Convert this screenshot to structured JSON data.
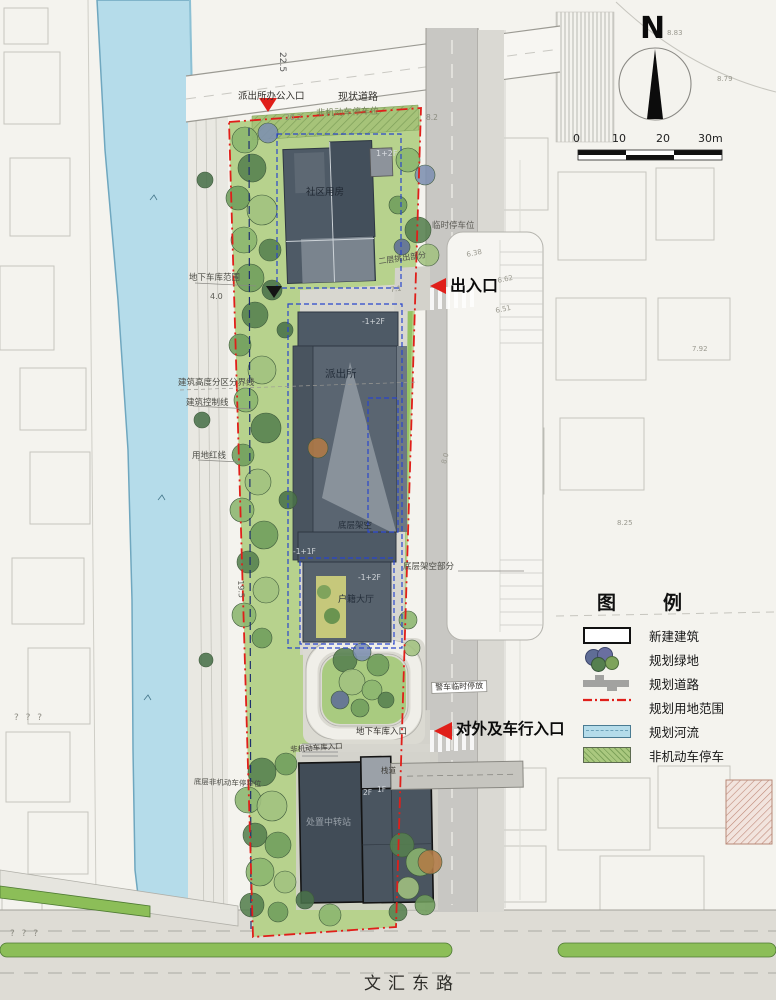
{
  "colors": {
    "boundary_red": "#e01f1a",
    "site_green": "#b7d28d",
    "river_blue": "#b5dcea",
    "road_gray": "#c8c7c3",
    "building_dark": "#4e5a66",
    "bright_green": "#95c463",
    "navy_dash": "#1d2f6e",
    "blue_dash": "#2945cc"
  },
  "compass": {
    "label": "N"
  },
  "scalebar": {
    "t0": "0",
    "t10": "10",
    "t20": "20",
    "t30": "30m"
  },
  "legend": {
    "title": "图　例",
    "items": [
      {
        "key": "new-building",
        "label": "新建建筑"
      },
      {
        "key": "planned-green",
        "label": "规划绿地"
      },
      {
        "key": "planned-road",
        "label": "规划道路"
      },
      {
        "key": "site-boundary",
        "label": "规划用地范围"
      },
      {
        "key": "planned-river",
        "label": "规划河流"
      },
      {
        "key": "nonmotor-parking",
        "label": "非机动车停车"
      }
    ]
  },
  "plan": {
    "dim_22_5": "22.5",
    "office_entrance": "派出所办公入口",
    "existing_road": "现状道路",
    "dim_20_2": "20.2",
    "nonmotor_row": "非机动车停车位",
    "dim_8_2": "8.2",
    "community_room": "社区用房",
    "floors_1_2f": "1+2F",
    "overhang_2f": "二层挑出部分",
    "temp_parking": "临时停车位",
    "entrance_exit": "出入口",
    "garage_extent": "地下车库范围",
    "dim_4_0": "4.0",
    "height_zone_line": "建筑高度分区分界线",
    "building_control_line": "建筑控制线",
    "land_red_line": "用地红线",
    "police_station": "派出所",
    "floors_m1_2f_top": "-1+2F",
    "ground_floor_open": "底层架空",
    "floors_m1_1f": "-1+1F",
    "open_part": "底层架空部分",
    "floors_m1_2f": "-1+2F",
    "household_hall": "户籍大厅",
    "dim_19_5": "19.5",
    "dim_7_1": "7.1",
    "police_car_parking": "警车临时停放",
    "garage_entrance": "地下车库入口",
    "main_entrance": "对外及车行入口",
    "nonmotor_entrance": "非机动车库入口",
    "ground_nonmotor": "底层非机动车停车位",
    "walkway": "栈道",
    "floors_2f": "2F",
    "floors_1f": "1F",
    "transfer_station": "处置中转站",
    "road_name": "文汇东路",
    "qmarks": "? ? ?"
  },
  "spots": {
    "e638": "6.38",
    "e662": "6.62",
    "e651": "6.51",
    "e80": "8.0",
    "e883": "8.83",
    "e879": "8.79",
    "e825": "8.25",
    "e792": "7.92"
  }
}
